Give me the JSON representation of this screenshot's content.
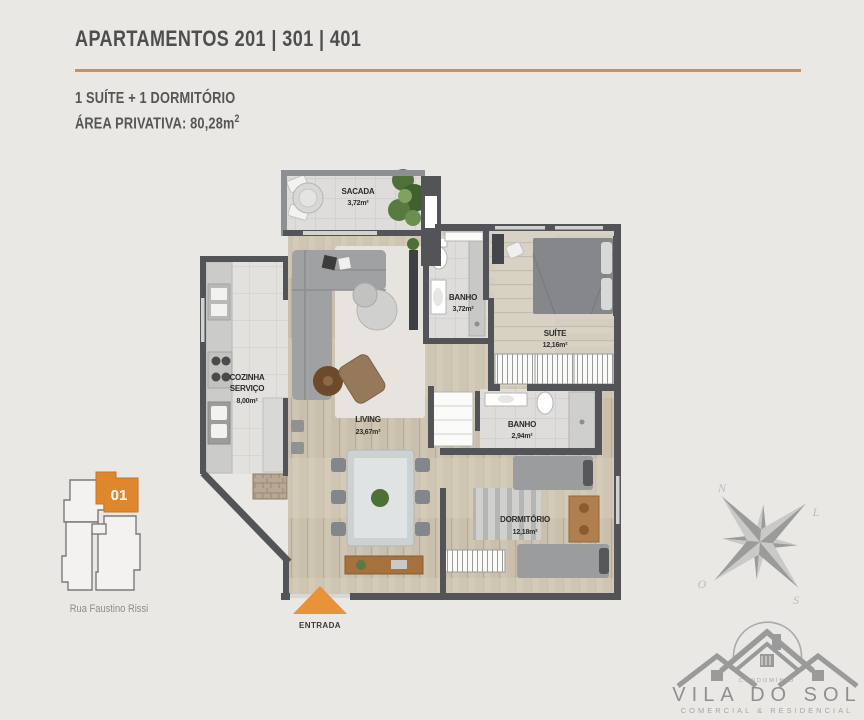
{
  "header": {
    "title": "APARTAMENTOS 201 | 301 | 401",
    "line1": "1 SUÍTE + 1 DORMITÓRIO",
    "line2": "ÁREA PRIVATIVA: 80,28m",
    "line2_sup": "2"
  },
  "plan": {
    "rooms": {
      "sacada": {
        "name": "SACADA",
        "area": "3,72m²"
      },
      "banho1": {
        "name": "BANHO",
        "area": "3,72m²"
      },
      "suite": {
        "name": "SUÍTE",
        "area": "12,16m²"
      },
      "cozinha": {
        "name1": "COZINHA",
        "name2": "SERVIÇO",
        "area": "8,00m²"
      },
      "living": {
        "name": "LIVING",
        "area": "23,67m²"
      },
      "banho2": {
        "name": "BANHO",
        "area": "2,94m²"
      },
      "dormitorio": {
        "name": "DORMITÓRIO",
        "area": "12,18m²"
      }
    },
    "entrance_label": "ENTRADA"
  },
  "location": {
    "unit_number": "01",
    "street": "Rua Faustino Rissi"
  },
  "compass": {
    "n": "N",
    "l": "L",
    "o": "O",
    "s": "S"
  },
  "logo": {
    "small_top": "CONDOMÍNIO",
    "name": "VILA DO SOL",
    "tagline": "COMERCIAL & RESIDENCIAL"
  },
  "colors": {
    "accent_orange": "#e0862c",
    "rule_orange": "#d98c4e",
    "wall_gray": "#535458",
    "background": "#e9e8e5"
  }
}
